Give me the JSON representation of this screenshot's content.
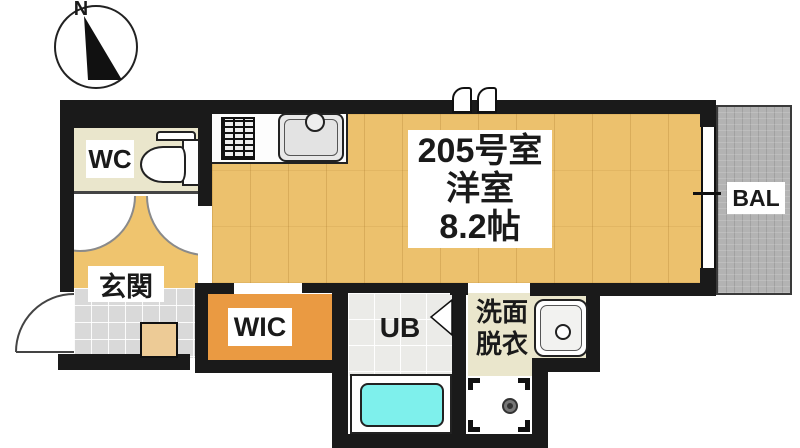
{
  "title": "apartment-floor-plan",
  "compass": {
    "label": "N"
  },
  "rooms": {
    "wc": {
      "label": "WC"
    },
    "entrance": {
      "label": "玄関"
    },
    "main": {
      "number": "205号室",
      "type": "洋室",
      "size": "8.2帖"
    },
    "wic": {
      "label": "WIC"
    },
    "unit_bath": {
      "label": "UB"
    },
    "washroom": {
      "line1": "洗面",
      "line2": "脱衣"
    },
    "balcony": {
      "label": "BAL"
    }
  },
  "colors": {
    "wall": "#1a1a1a",
    "wood_floor": "#ecc16d",
    "wic_floor": "#ea9a42",
    "cream_floor": "#eae6cc",
    "entrance_tile": "#d9d9d9",
    "ub_tile": "#ebebe8",
    "balcony_gray": "#b3b3b3",
    "bathtub_cyan": "#7ef0ec"
  }
}
